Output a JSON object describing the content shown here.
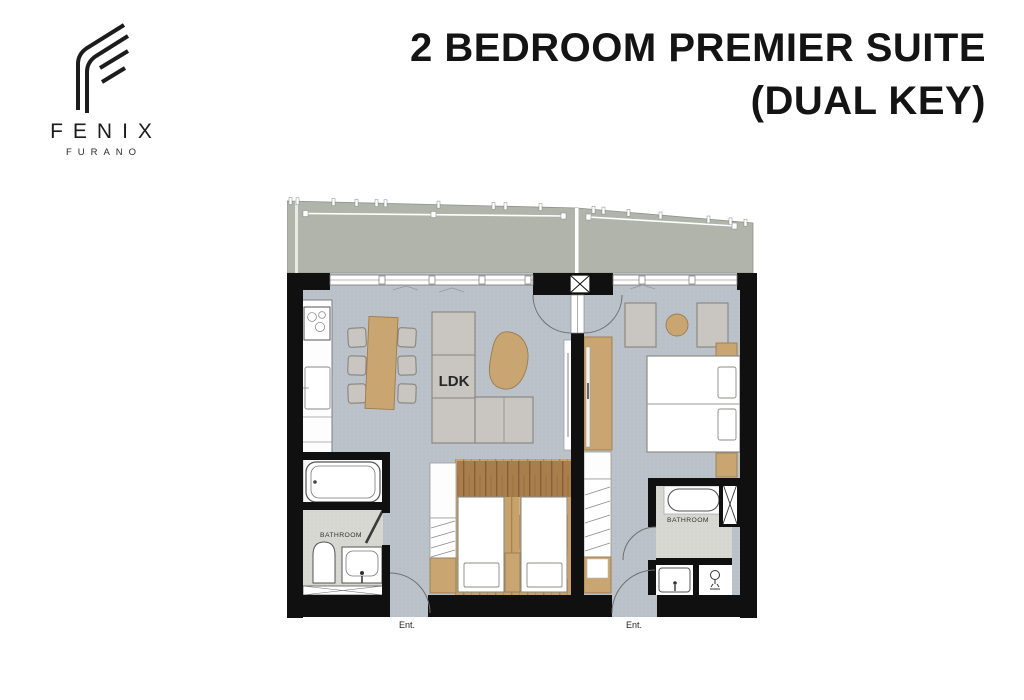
{
  "brand": {
    "name": "FENIX",
    "subname": "FURANO",
    "logo_icon": "fenix-f-logo-mark"
  },
  "title": {
    "line1": "2 BEDROOM PREMIER SUITE",
    "line2": "(DUAL KEY)"
  },
  "floor_plan": {
    "labels": {
      "living": "LDK",
      "bathroom_left": "BATHROOM",
      "bathroom_right": "BATHROOM",
      "entrance_left": "Ent.",
      "entrance_right": "Ent."
    },
    "colors": {
      "wall": "#101010",
      "interior_floor": "#bcc2ca",
      "balcony": "#b1b4ab",
      "bathroom_floor": "#d8d8d3",
      "wood_floor": "#c8a26b",
      "furniture_gray": "#c9c6c1",
      "accent_tan": "#c9a572",
      "title_text": "#141414"
    }
  }
}
